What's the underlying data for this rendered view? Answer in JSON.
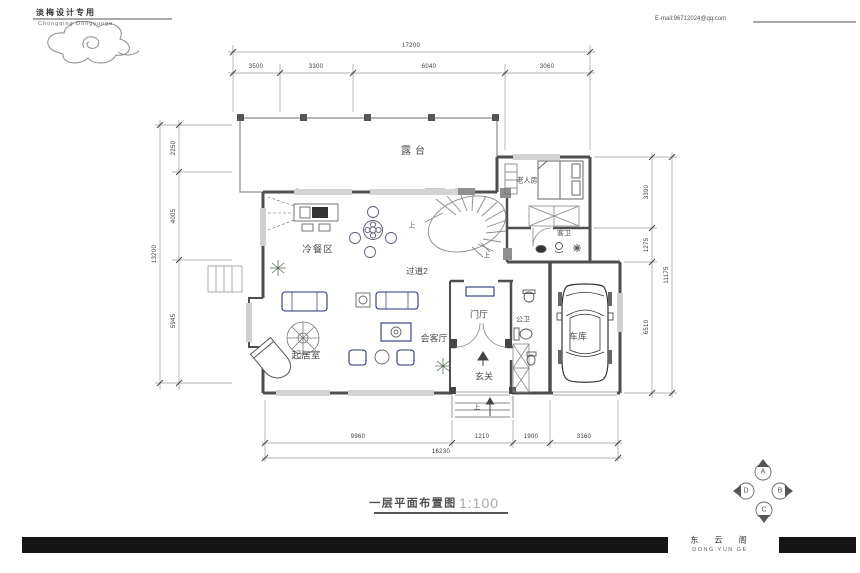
{
  "header": {
    "brand_cn": "淡梅设计专用",
    "brand_en": "Chongqing Dongyunge",
    "email": "E-mail:96712024@qq.com"
  },
  "plan": {
    "rooms": {
      "terrace": "露台",
      "elder_room": "老人房",
      "guest_bath": "客卫",
      "buffet_area": "冷餐区",
      "corridor": "过道2",
      "living_room": "起居室",
      "reception": "会客厅",
      "entry_hall": "门厅",
      "public_bath": "公卫",
      "foyer": "玄关",
      "garage": "车库"
    },
    "up_label": "上",
    "dimensions": {
      "top": {
        "total": "17200",
        "segments": [
          "3500",
          "3300",
          "6040",
          "3060"
        ]
      },
      "left": {
        "total": "13200",
        "segments": [
          "2250",
          "4005",
          "5945"
        ]
      },
      "right": {
        "total": "11175",
        "segments": [
          "3390",
          "1275",
          "6510"
        ]
      },
      "bottom": {
        "total": "16230",
        "segments": [
          "9960",
          "1210",
          "1900",
          "3160"
        ]
      }
    }
  },
  "title_block": {
    "title": "一层平面布置图",
    "scale": "1:100"
  },
  "compass": {
    "top": "A",
    "right": "B",
    "bottom": "C",
    "left": "D"
  },
  "footer": {
    "studio_cn": "东 云 阁",
    "studio_en": "DONG YUN GE"
  },
  "colors": {
    "wall": "#4f4f4f",
    "line": "#999999",
    "furniture_accent": "#27357a",
    "footer_bar": "#151515"
  }
}
